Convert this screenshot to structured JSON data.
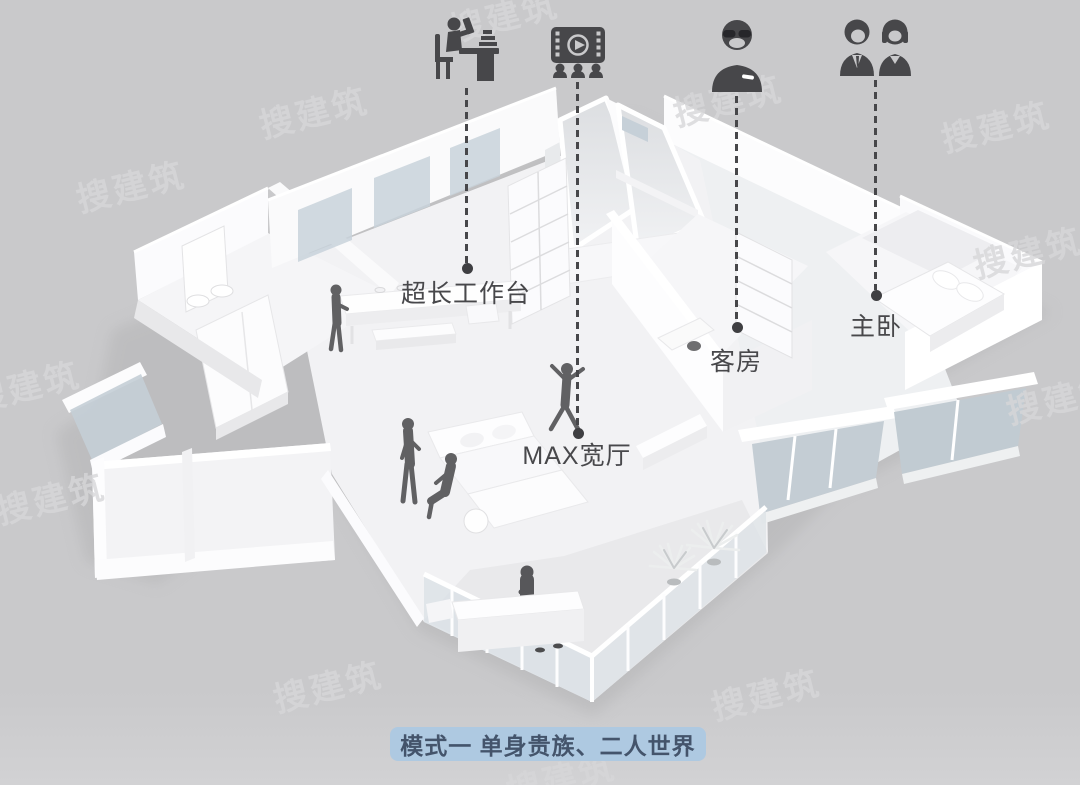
{
  "page": {
    "background_color": "#c9c9cb",
    "watermark": {
      "text": "搜建筑"
    },
    "caption": {
      "text": "模式一 单身贵族、二人世界",
      "background_color": "#aec9e1",
      "text_color": "#44546b"
    }
  },
  "annotations": [
    {
      "id": "worktable",
      "icon": "person-reading-at-desk-icon",
      "label": "超长工作台"
    },
    {
      "id": "wide-hall",
      "icon": "home-cinema-icon",
      "label": "MAX宽厅"
    },
    {
      "id": "guest-room",
      "icon": "single-person-icon",
      "label": "客房"
    },
    {
      "id": "master-bedroom",
      "icon": "couple-icon",
      "label": "主卧"
    }
  ],
  "style": {
    "icon_color": "#47474a",
    "label_color": "#48484b",
    "leader_line_color": "#47474a",
    "glass_color": "#c5cfd7",
    "model_white": "#fdfdfe"
  }
}
